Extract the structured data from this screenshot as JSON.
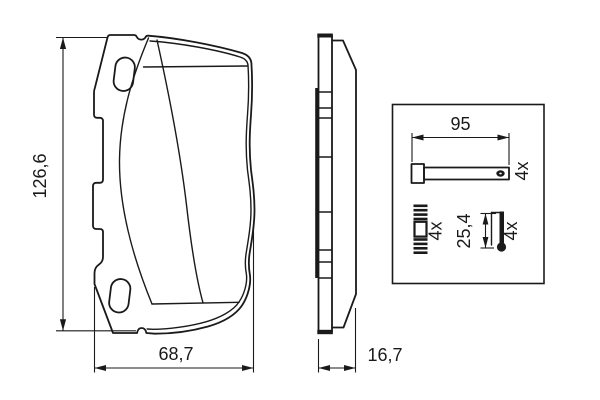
{
  "front_view": {
    "height": "126,6",
    "width": "68,7"
  },
  "side_view": {
    "thickness": "16,7"
  },
  "hardware": {
    "pin": {
      "length": "95",
      "qty": "4x"
    },
    "spring": {
      "qty": "4x"
    },
    "sleeve": {
      "length": "25,4",
      "qty": "4x"
    }
  },
  "colors": {
    "line": "#1a1a1a",
    "background": "#ffffff"
  }
}
